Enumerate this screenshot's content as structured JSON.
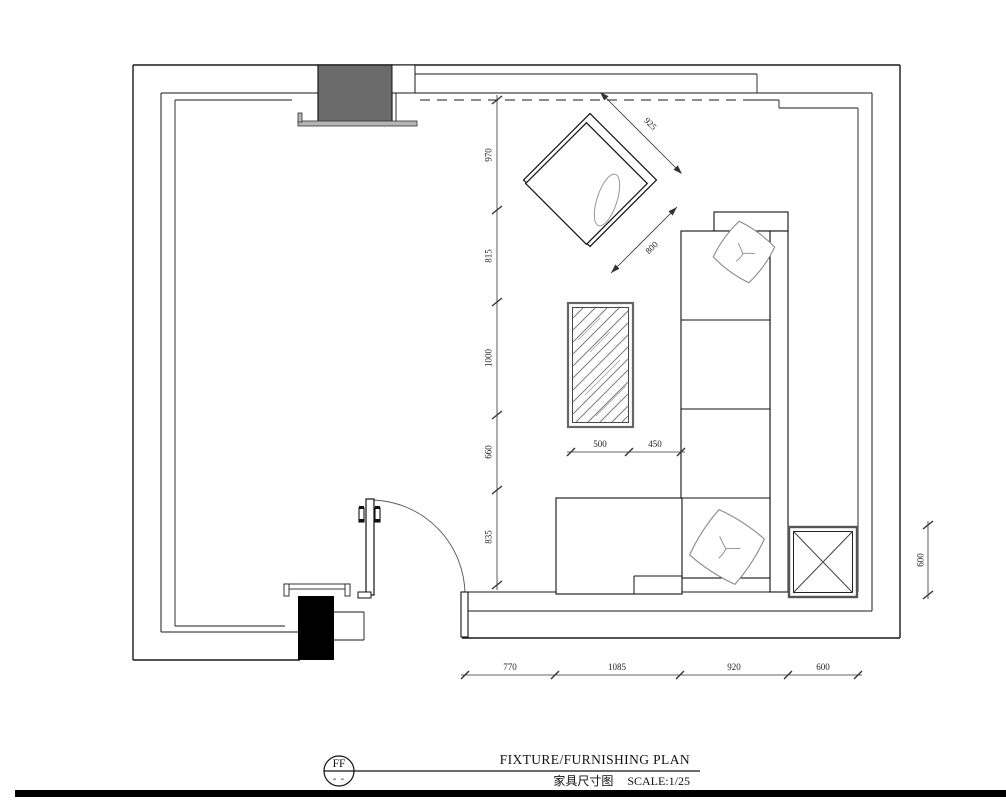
{
  "drawing": {
    "type": "floor-plan",
    "room": "living room furnishing layout"
  },
  "dims": {
    "left": [
      "970",
      "815",
      "1000",
      "660",
      "835"
    ],
    "bottom": [
      "770",
      "1085",
      "920",
      "600"
    ],
    "right": [
      "600"
    ],
    "sofa": [
      "500",
      "450"
    ],
    "chair": [
      "925",
      "800"
    ]
  },
  "title_block": {
    "ref": "FF",
    "ref_sub": "- -",
    "title_en": "FIXTURE/FURNISHING PLAN",
    "title_zh": "家具尺寸图",
    "scale": "SCALE:1/25"
  },
  "colors": {
    "line": "#1a1a1a",
    "dim_line": "#333333",
    "column_gray": "#6b6b6b",
    "column_black": "#000000",
    "soft_furnishing": "#8a8a8a"
  }
}
